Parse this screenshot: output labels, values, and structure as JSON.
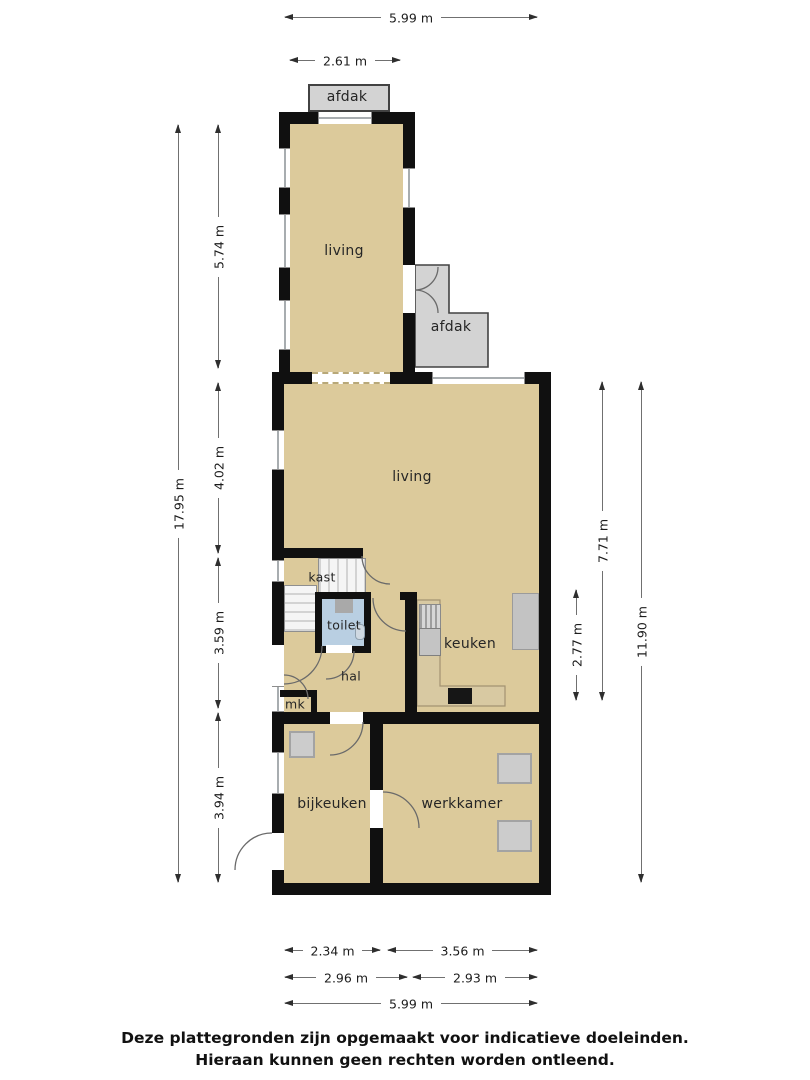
{
  "rooms": {
    "afdak_top": "afdak",
    "living_upper": "living",
    "afdak_side": "afdak",
    "living": "living",
    "kast": "kast",
    "toilet": "toilet",
    "hal": "hal",
    "mk": "mk",
    "keuken": "keuken",
    "bijkeuken": "bijkeuken",
    "werkkamer": "werkkamer"
  },
  "dimensions": {
    "top_total": "5.99 m",
    "top_afdak": "2.61 m",
    "left_total": "17.95 m",
    "left_upper": "5.74 m",
    "left_living": "4.02 m",
    "left_hal": "3.59 m",
    "left_bijkeuken": "3.94 m",
    "right_keuken": "2.77 m",
    "right_living": "7.71 m",
    "right_total": "11.90 m",
    "bottom_bijkeuken": "2.34 m",
    "bottom_werkkamer": "3.56 m",
    "bottom_left_mid": "2.96 m",
    "bottom_right_mid": "2.93 m",
    "bottom_total": "5.99 m"
  },
  "footer": {
    "line1": "Deze plattegronden zijn opgemaakt voor indicatieve doeleinden.",
    "line2": "Hieraan kunnen geen rechten worden ontleend."
  },
  "colors": {
    "floor": "#dcca9b",
    "wall": "#101010",
    "canopy": "#d3d3d3",
    "toilet_floor": "#b9cfe2",
    "counter": "#d8c9a2",
    "fixture_gray": "#cccccc"
  }
}
